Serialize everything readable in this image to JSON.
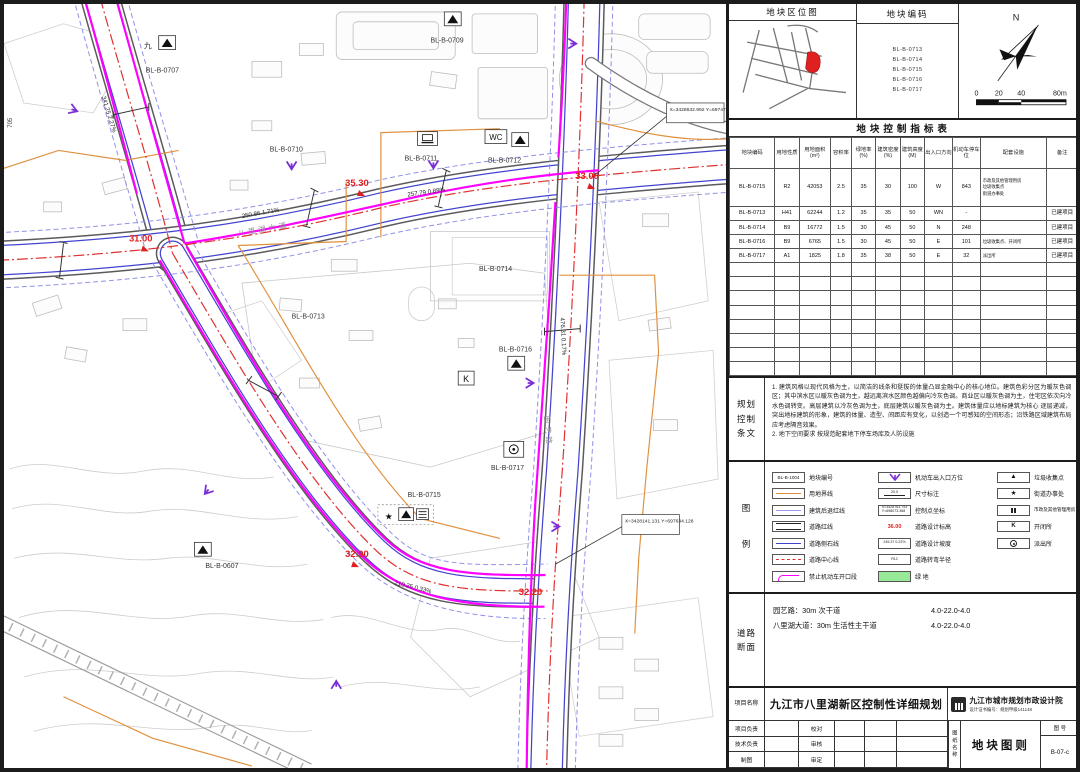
{
  "colors": {
    "magenta": "#ff00ff",
    "red_annotation": "#e02020",
    "property_orange": "#e0913f",
    "curb_blue": "#4343cf",
    "setback_blue": "#9090e8",
    "entrance_purple": "#7b2fd6",
    "green_space": "#97e897"
  },
  "map": {
    "plots": [
      "BL-B-0707",
      "BL-B-0709",
      "BL-B-0710",
      "BL-B-0711",
      "BL-B-0712",
      "BL-B-0713",
      "BL-B-0714",
      "BL-B-0716",
      "BL-B-0717",
      "BL-B-0715",
      "BL-B-0607"
    ],
    "elevations": [
      "31.00",
      "35.30",
      "33.00",
      "32.90",
      "32.20"
    ],
    "slopes": [
      "341.25 2.27%",
      "250.86 1.71%",
      "257.79 0.89%",
      "476.31 0.17%",
      "210.25 0.33%"
    ],
    "road_names": [
      "八里湖大道",
      "园艺路"
    ],
    "control_points": [
      "X=3428632.992\nY=697473.506",
      "X=3428141.131\nY=697634.128"
    ],
    "jiu": "九",
    "wc": "WC",
    "k": "K",
    "edge_label": "705"
  },
  "panel": {
    "location_map": {
      "title": "地块区位图"
    },
    "plot_codes": {
      "title": "地块编码",
      "codes": "BL-B-0713\nBL-B-0714\nBL-B-0715\nBL-B-0716\nBL-B-0717"
    },
    "north": {
      "label": "N",
      "scale_ticks": [
        "0",
        "20",
        "40",
        "80m"
      ]
    },
    "table": {
      "title": "地块控制指标表",
      "headers": [
        "地块编码",
        "用地性质",
        "用地面积(m²)",
        "容积率",
        "绿地率(%)",
        "建筑密度(%)",
        "建筑高度(M)",
        "出入口方向",
        "机动车停车位",
        "配套设施",
        "备注"
      ],
      "rows": [
        [
          "BL-B-0715",
          "R2",
          "42053",
          "2.5",
          "35",
          "30",
          "100",
          "W",
          "843",
          "市政及其他管理用房\n垃圾收集点\n街道办事处",
          ""
        ],
        [
          "BL-B-0713",
          "H41",
          "62244",
          "1.2",
          "35",
          "35",
          "50",
          "WN",
          "-",
          "",
          "已建项目"
        ],
        [
          "BL-B-0714",
          "B9",
          "16772",
          "1.5",
          "30",
          "45",
          "50",
          "N",
          "248",
          "",
          "已建项目"
        ],
        [
          "BL-B-0716",
          "B9",
          "6765",
          "1.5",
          "30",
          "45",
          "50",
          "E",
          "101",
          "垃圾收集点、开闭所",
          "已建项目"
        ],
        [
          "BL-B-0717",
          "A1",
          "1825",
          "1.8",
          "35",
          "38",
          "50",
          "E",
          "32",
          "派出所",
          "已建项目"
        ]
      ]
    },
    "provisions": {
      "label": "规划\n控制\n条文",
      "text": "1. 建筑风格以现代风格为主，以简洁的线条和挺拔的体量凸显金融中心的核心地位。建筑色彩分区为暖灰色调区；其中滨水区以暖灰色调为主，越远离滨水区颜色越偏向冷灰色调。商业区以暖灰色调为主，住宅区依次向冷水色调转变。高层建筑以冷灰色调为主，底层建筑以暖灰色调为主。建筑体量应以地标建筑为核心 逐层递减，突出地标建筑的形象，建筑的体量、造型、间距应有变化，以创造一个可感知的空间形态；沿铁路区域建筑布局应考虑隔音效果。\n2. 地下空间要求 按规范配套地下停车场库及人防设施"
    },
    "legend": {
      "label": "图\n例",
      "items1": [
        {
          "s": "BL-B-1004",
          "t": "地块编号"
        },
        {
          "t": "用地界线"
        },
        {
          "t": "建筑后退红线"
        },
        {
          "t": "道路红线"
        },
        {
          "t": "道路侧石线"
        },
        {
          "t": "道路中心线"
        },
        {
          "t": "禁止机动车开口段"
        }
      ],
      "items2": [
        {
          "t": "机动车出入口方位"
        },
        {
          "s": "20.0",
          "t": "尺寸标注"
        },
        {
          "s": "X=3428763.793\nY=698073.368",
          "t": "控制点坐标"
        },
        {
          "s": "36.00",
          "t": "道路设计标高"
        },
        {
          "s": "245.37 0.22%",
          "t": "道路设计坡度"
        },
        {
          "s": "R12",
          "t": "道路转弯半径"
        },
        {
          "t": "绿    地"
        }
      ],
      "items3": [
        {
          "t": "垃圾收集点"
        },
        {
          "t": "街道办事处"
        },
        {
          "t": "市政及其他管理用房"
        },
        {
          "s": "K",
          "t": "开闭所"
        },
        {
          "t": "派出所"
        }
      ]
    },
    "road_sections": {
      "label": "道路\n断面",
      "items": [
        {
          "name": "园艺路：30m 次干道",
          "widths": "4.0-22.0-4.0"
        },
        {
          "name": "八里湖大道：30m 生活性主干道",
          "widths": "4.0-22.0-4.0"
        }
      ]
    },
    "title_block": {
      "project_label": "项目名称",
      "project_name": "九江市八里湖新区控制性详细规划",
      "institute": "九江市城市规划市政设计院",
      "cert": "设计证书编号：规划甲级141148",
      "role1": "项目负责",
      "role2": "技术负责",
      "role3": "制图",
      "check1": "校对",
      "check2": "审核",
      "check3": "审定",
      "sheet_label": "图纸名称",
      "sheet_name": "地块图则",
      "no_label": "图 号",
      "sheet_no": "B-07-c"
    }
  }
}
